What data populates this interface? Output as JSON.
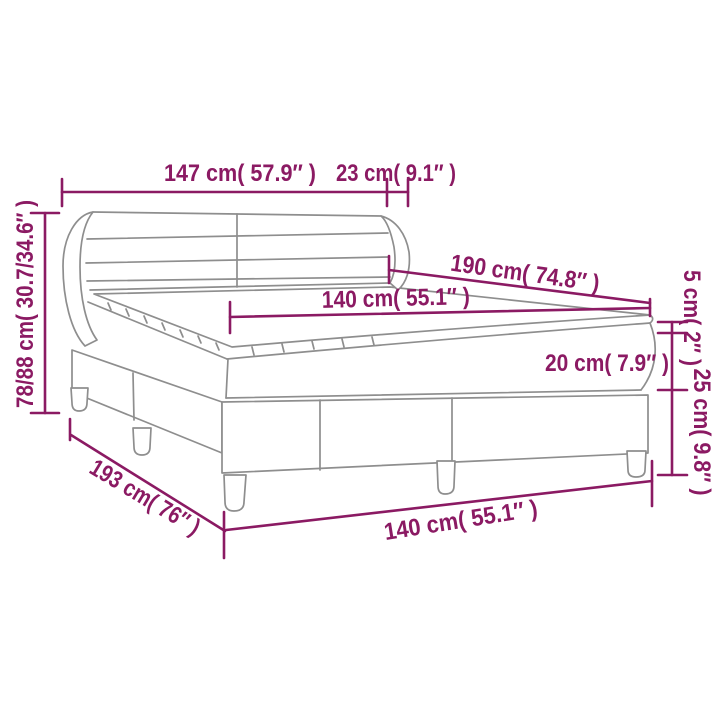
{
  "diagram": {
    "title": "box-spring-bed-dimension-diagram",
    "colors": {
      "dimension_accent": "#8b1a63",
      "line_art": "#8e8e8e",
      "background": "#ffffff"
    },
    "dimensions": {
      "headboard_width": "147 cm( 57.9″ )",
      "headboard_depth": "23 cm( 9.1″ )",
      "bed_length": "190 cm( 74.8″ )",
      "mattress_width": "140 cm( 55.1″ )",
      "total_height": "78/88 cm( 30.7/34.6″ )",
      "topper_height": "5 cm( 2″ )",
      "mattress_height": "20 cm( 7.9″ )",
      "base_height": "25 cm( 9.8″ )",
      "total_length": "193 cm( 76″ )",
      "base_width": "140 cm( 55.1″ )"
    }
  }
}
